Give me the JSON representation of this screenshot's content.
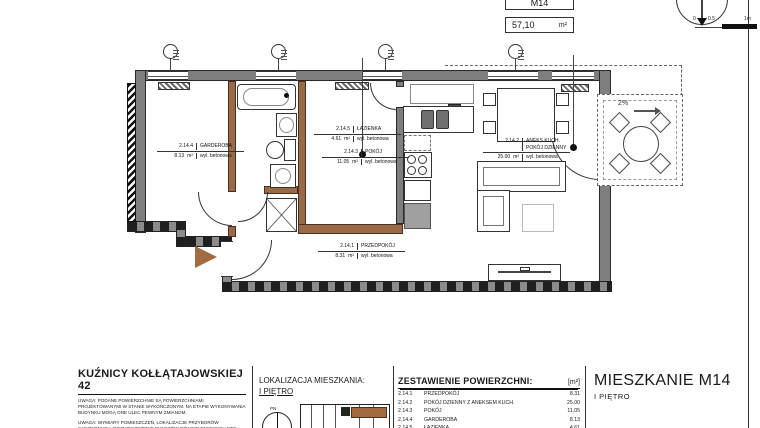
{
  "header": {
    "unit_code": "M14",
    "area_value": "57,10",
    "area_unit": "m²",
    "scale": {
      "zero": "0",
      "half": "0.5",
      "one": "1m"
    }
  },
  "plan": {
    "balcony_slope": "2%",
    "rooms": [
      {
        "id": "2.14.1",
        "name": "PRZEDPOKÓJ",
        "area": "8.31",
        "unit": "m²",
        "floor": "wyl. betonowa"
      },
      {
        "id": "2.14.2",
        "name": "ANEKS KUCH.",
        "name2": "POKÓJ DZIENNY",
        "area": "25.00",
        "unit": "m²",
        "floor": "wyl. betonowa"
      },
      {
        "id": "2.14.3",
        "name": "POKÓJ",
        "area": "11.05",
        "unit": "m²",
        "floor": "wyl. betonowa"
      },
      {
        "id": "2.14.4",
        "name": "GARDEROBA",
        "area": "8.13",
        "unit": "m²",
        "floor": "wyl. betonowa"
      },
      {
        "id": "2.14.5",
        "name": "ŁAZIENKA",
        "area": "4.61",
        "unit": "m²",
        "floor": "wyl. betonowa"
      }
    ]
  },
  "footer": {
    "address": {
      "title": "KUŹNICY KOŁŁĄTAJOWSKIEJ 42",
      "note1": "UWAGA: PODANE POWIERZCHNIE SĄ POWIERZCHNIAMI PROJEKTOWANYMI W STANIE WYKOŃCZONYM. NA ETAPIE WYKONYWANIA BUDYNKU MOGĄ ONE ULEC PEWNYM ZMIANOM.",
      "note2": "UWAGA: WYMIARY POMIESZCZEŃ, LOKALIZACJE PRZYBORÓW SANITARNYCH, ROZMIESZCZENIE PUNKTÓW OŚWIETLENIOWYCH ETC. PODANO ZGODNIE Z"
    },
    "location": {
      "title": "LOKALIZACJA MIESZKANIA:",
      "floor": "I PIĘTRO",
      "compass_label": "PN"
    },
    "table": {
      "title": "ZESTAWIENIE POWIERZCHNI:",
      "unit": "[m²]",
      "rows": [
        {
          "id": "2.14.1",
          "name": "PRZEDPOKÓJ",
          "area": "8.31"
        },
        {
          "id": "2.14.2",
          "name": "POKÓJ DZIENNY Z ANEKSEM KUCH.",
          "area": "25.00"
        },
        {
          "id": "2.14.3",
          "name": "POKÓJ",
          "area": "11.05"
        },
        {
          "id": "2.14.4",
          "name": "GARDEROBA",
          "area": "8.13"
        },
        {
          "id": "2.14.5",
          "name": "ŁAZIENKA",
          "area": "4.61"
        }
      ]
    },
    "apartment": {
      "title": "MIESZKANIE M14",
      "floor": "I PIĘTRO"
    }
  }
}
